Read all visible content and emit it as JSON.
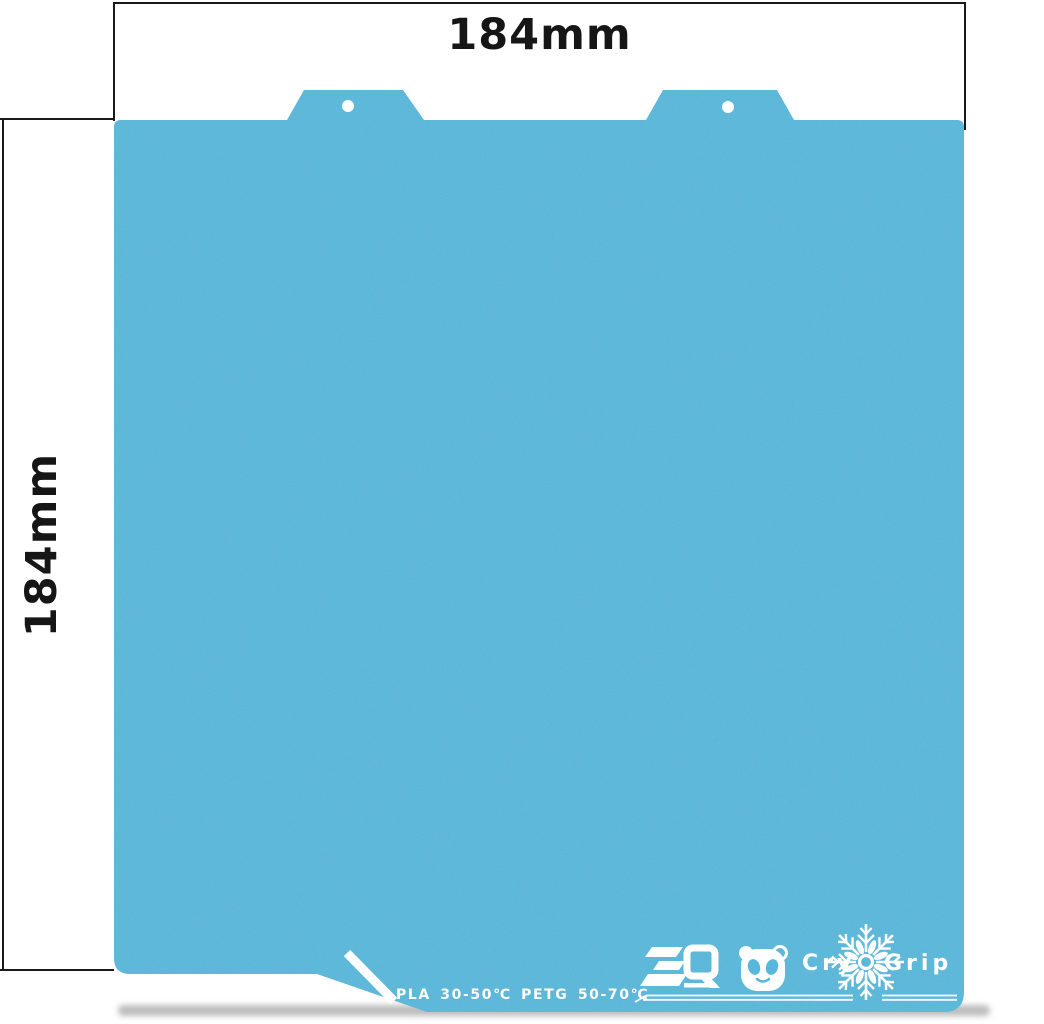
{
  "background_color": "#ffffff",
  "dimension_annotations": {
    "line_color": "#1a1a1a",
    "top": {
      "label": "184mm"
    },
    "left": {
      "label": "184mm"
    }
  },
  "plate": {
    "product": "CryoGrip flexible build plate",
    "surface_color": "#58b8db",
    "print_color": "#ffffff",
    "temperature_label": "PLA 30-50℃ PETG 50-70℃",
    "branding": {
      "bq_logo": "biqu-bq-logo",
      "panda": "panda-icon",
      "snowflake": "snowflake-icon",
      "cryogrip_left": "Cry",
      "cryogrip_right": "Grip"
    },
    "features": {
      "mounting_tabs": 2,
      "mounting_holes": 2
    }
  }
}
